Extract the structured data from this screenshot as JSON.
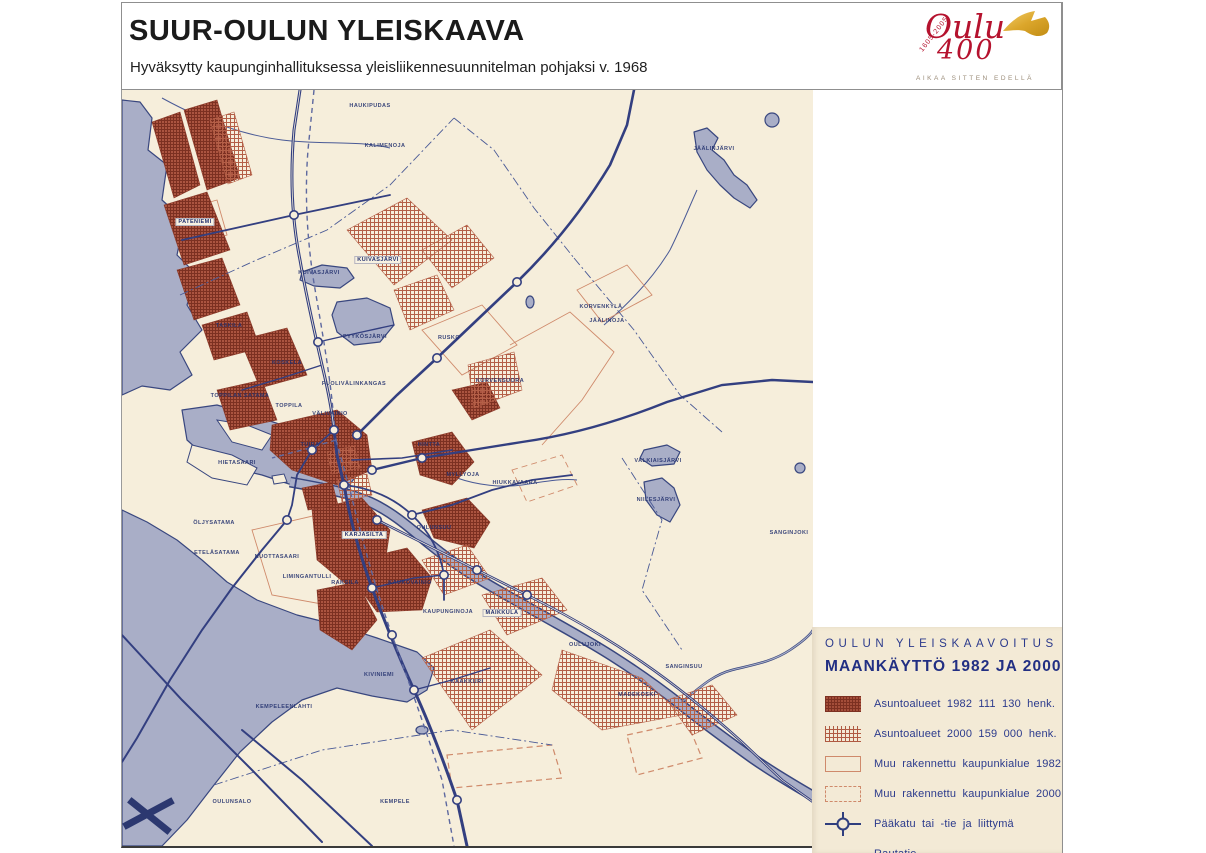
{
  "header": {
    "title": "SUUR-OULUN YLEISKAAVA",
    "subtitle": "Hyväksytty kaupunginhallituksessa yleisliikennesuunnitelman pohjaksi v. 1968",
    "logo": {
      "years": "1605-2005",
      "name": "Oulu",
      "number": "400",
      "tagline": "AIKAA SITTEN EDELLÄ"
    }
  },
  "legend": {
    "kicker": "OULUN YLEISKAAVOITUS",
    "title": "MAANKÄYTTÖ 1982 JA 2000",
    "items": [
      {
        "label": "Asuntoalueet 1982 111 130 henk.",
        "swatch": "hatch-1982"
      },
      {
        "label": "Asuntoalueet 2000 159 000 henk.",
        "swatch": "hatch-2000"
      },
      {
        "label": "Muu rakennettu kaupunkialue 1982",
        "swatch": "outline-1982"
      },
      {
        "label": "Muu rakennettu kaupunkialue 2000",
        "swatch": "outline-2000"
      },
      {
        "label": "Pääkatu tai -tie ja liittymä",
        "swatch": "road"
      },
      {
        "label": "Rautatie",
        "swatch": "rail"
      }
    ]
  },
  "map": {
    "labels": [
      {
        "text": "HAUKIPUDAS",
        "x": 248,
        "y": 16
      },
      {
        "text": "KALIMENOJA",
        "x": 263,
        "y": 56
      },
      {
        "text": "JÄÄLINJÄRVI",
        "x": 592,
        "y": 59
      },
      {
        "text": "PATENIEMI",
        "x": 73,
        "y": 132,
        "chip": true
      },
      {
        "text": "KUIVASJÄRVI",
        "x": 256,
        "y": 170,
        "chip": true
      },
      {
        "text": "KUIVASJÄRVI",
        "x": 197,
        "y": 183
      },
      {
        "text": "TASKILA",
        "x": 107,
        "y": 236
      },
      {
        "text": "PYYKÖSJÄRVI",
        "x": 243,
        "y": 247
      },
      {
        "text": "RUSKO",
        "x": 327,
        "y": 248
      },
      {
        "text": "KORVENKYLÄ",
        "x": 479,
        "y": 217
      },
      {
        "text": "JÄÄLINOJA",
        "x": 485,
        "y": 231
      },
      {
        "text": "KORVENSUORA",
        "x": 378,
        "y": 291
      },
      {
        "text": "KOSKELA",
        "x": 165,
        "y": 273
      },
      {
        "text": "PUOLIVÄLINKANGAS",
        "x": 232,
        "y": 294
      },
      {
        "text": "TOPPILAN SATAMA",
        "x": 118,
        "y": 306
      },
      {
        "text": "TOPPILA",
        "x": 167,
        "y": 316
      },
      {
        "text": "VÄLIVAINIO",
        "x": 208,
        "y": 324
      },
      {
        "text": "TUIRA",
        "x": 188,
        "y": 355
      },
      {
        "text": "HINTTA",
        "x": 307,
        "y": 355
      },
      {
        "text": "MYLLYOJA",
        "x": 341,
        "y": 385
      },
      {
        "text": "HIETASAARI",
        "x": 115,
        "y": 373
      },
      {
        "text": "HIUKKAVAARA",
        "x": 393,
        "y": 393
      },
      {
        "text": "VALKIAISJÄRVI",
        "x": 536,
        "y": 371
      },
      {
        "text": "NIILESJÄRVI",
        "x": 534,
        "y": 410
      },
      {
        "text": "ÖLJYSATAMA",
        "x": 92,
        "y": 433
      },
      {
        "text": "KARJASILTA",
        "x": 242,
        "y": 445,
        "chip": true
      },
      {
        "text": "OULUNSUU",
        "x": 312,
        "y": 438
      },
      {
        "text": "ETELÄSATAMA",
        "x": 95,
        "y": 463
      },
      {
        "text": "NUOTTASAARI",
        "x": 155,
        "y": 467
      },
      {
        "text": "LIMINGANTULLI",
        "x": 185,
        "y": 487
      },
      {
        "text": "RAKSILA",
        "x": 223,
        "y": 493
      },
      {
        "text": "KAUKOVAINIO",
        "x": 288,
        "y": 493
      },
      {
        "text": "KAUPUNGINOJA",
        "x": 326,
        "y": 522
      },
      {
        "text": "MAIKKULA",
        "x": 380,
        "y": 523,
        "chip": true
      },
      {
        "text": "OULUJOKI",
        "x": 463,
        "y": 555
      },
      {
        "text": "KIVINIEMI",
        "x": 257,
        "y": 585
      },
      {
        "text": "KAAKKURI",
        "x": 345,
        "y": 592
      },
      {
        "text": "SANGINSUU",
        "x": 562,
        "y": 577
      },
      {
        "text": "MADEKOSKI",
        "x": 515,
        "y": 605
      },
      {
        "text": "SANGINJOKI",
        "x": 667,
        "y": 443
      },
      {
        "text": "KEMPELEENLAHTI",
        "x": 162,
        "y": 617
      },
      {
        "text": "OULUNSALO",
        "x": 110,
        "y": 712
      },
      {
        "text": "KEMPELE",
        "x": 273,
        "y": 712
      }
    ]
  },
  "colors": {
    "paper": "#f6eedb",
    "water": "#a9aec7",
    "coastline": "#39477f",
    "road": "#333f80",
    "railway": "#8891bb",
    "residential_1982": "#9c4634",
    "residential_2000": "#b86048",
    "built_outline": "#cf8a6b",
    "legend_text": "#2b3a8c",
    "legend_background": "#f3ead6",
    "logo_red": "#b5122e",
    "flag_gold": "#dba62b"
  }
}
